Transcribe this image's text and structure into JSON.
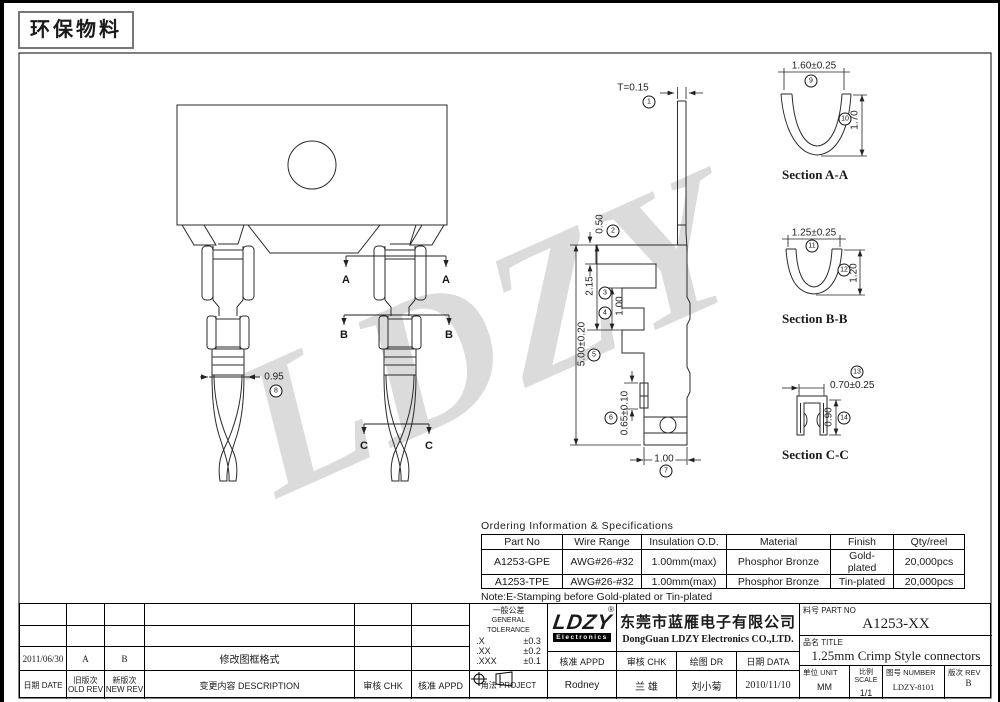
{
  "page": {
    "eco_label": "环保物料",
    "watermark": "LDZY"
  },
  "views": {
    "cut_a": "A",
    "cut_b": "B",
    "cut_c": "C",
    "sections": {
      "a": "Section A-A",
      "b": "Section B-B",
      "c": "Section C-C"
    }
  },
  "dims": {
    "t": {
      "label": "T=0.15",
      "n": "1"
    },
    "d050": {
      "label": "0.50",
      "n": "2"
    },
    "d215": {
      "label": "2.15",
      "n": "3"
    },
    "d100m": {
      "label": "1.00",
      "n": "4"
    },
    "d500": {
      "label": "5.00±0.20",
      "n": "5"
    },
    "d065": {
      "label": "0.65±0.10",
      "n": "6"
    },
    "d100b": {
      "label": "1.00",
      "n": "7"
    },
    "d095": {
      "label": "0.95",
      "n": "8"
    },
    "d160": {
      "label": "1.60±0.25",
      "n": "9"
    },
    "d170": {
      "label": "1.70",
      "n": "10"
    },
    "d125": {
      "label": "1.25±0.25",
      "n": "11"
    },
    "d120": {
      "label": "1.20",
      "n": "12"
    },
    "d070": {
      "label": "0.70±0.25",
      "n": "13"
    },
    "d090": {
      "label": "0.90",
      "n": "14"
    }
  },
  "ordering": {
    "title": "Ordering Information & Specifications",
    "headers": [
      "Part No",
      "Wire Range",
      "Insulation O.D.",
      "Material",
      "Finish",
      "Qty/reel"
    ],
    "rows": [
      [
        "A1253-GPE",
        "AWG#26-#32",
        "1.00mm(max)",
        "Phosphor Bronze",
        "Gold-plated",
        "20,000pcs"
      ],
      [
        "A1253-TPE",
        "AWG#26-#32",
        "1.00mm(max)",
        "Phosphor Bronze",
        "Tin-plated",
        "20,000pcs"
      ]
    ],
    "note": "Note:E-Stamping before Gold-plated or Tin-plated"
  },
  "titleblock": {
    "revision": {
      "date": "2011/06/30",
      "old": "A",
      "new": "B",
      "desc": "修改图框格式",
      "date_label": "日期 DATE",
      "old_label1": "旧版次",
      "old_label2": "OLD REV",
      "new_label1": "新版次",
      "new_label2": "NEW REV",
      "desc_label": "变更内容 DESCRIPTION",
      "chk_label": "审核 CHK",
      "appd_label": "核准 APPD"
    },
    "tolerance": {
      "title1": "一般公差",
      "title2": "GENERAL TOLERANCE",
      "rows": [
        [
          ".X",
          "±0.3"
        ],
        [
          ".XX",
          "±0.2"
        ],
        [
          ".XXX",
          "±0.1"
        ]
      ]
    },
    "projection": {
      "label": "角法 PROJECT"
    },
    "logo": {
      "name": "LDZY",
      "sub": "Electronics",
      "reg": "®"
    },
    "company": {
      "cn": "东莞市蓝雁电子有限公司",
      "en": "DongGuan LDZY Electronics CO.,LTD."
    },
    "approval": {
      "appd_label": "核准 APPD",
      "chk_label": "审核 CHK",
      "dr_label": "绘图 DR",
      "date_label": "日期 DATA",
      "appd": "Rodney",
      "chk": "兰 雄",
      "dr": "刘小菊",
      "date": "2010/11/10"
    },
    "part": {
      "label": "料号 PART NO",
      "value": "A1253-XX"
    },
    "title": {
      "label": "品名 TITLE",
      "value": "1.25mm Crimp Style connectors"
    },
    "meta": {
      "unit_label": "单位 UNIT",
      "unit": "MM",
      "scale_label": "比例 SCALE",
      "scale": "1/1",
      "number_label": "图号 NUMBER",
      "number": "LDZY-8101",
      "rev_label": "版次 REV",
      "rev": "B"
    }
  }
}
